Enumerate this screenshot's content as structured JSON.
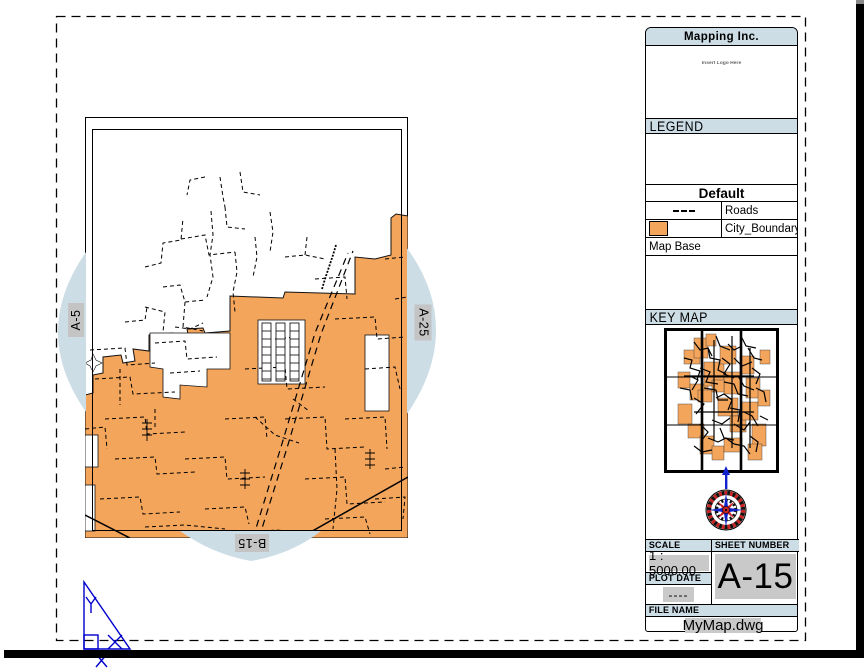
{
  "colors": {
    "band": "#ccdde6",
    "lens": "#ccdde6",
    "orange": "#f3a55c",
    "graybox": "#c4c4c4",
    "fieldgray": "#c9c9c9",
    "ucs_blue": "#0000cc",
    "compass_red": "#cc2222",
    "compass_blue": "#1122cc"
  },
  "sheet_labels": {
    "left": "A-5",
    "right": "A-25",
    "bottom": "B-15"
  },
  "title_block": {
    "company": "Mapping Inc.",
    "logo_placeholder": "Insert Logo Here",
    "legend": {
      "header": "LEGEND",
      "group": "Default",
      "items": [
        {
          "symbol": "dashed-line",
          "label": "Roads"
        },
        {
          "symbol": "orange-swatch",
          "label": "City_Boundary"
        }
      ],
      "footer": "Map Base"
    },
    "key_map_header": "KEY MAP",
    "scale": {
      "label": "SCALE",
      "value": "1 : 5000.00"
    },
    "sheet_number": {
      "label": "SHEET NUMBER",
      "value": "A-15"
    },
    "plot_date": {
      "label": "PLOT DATE",
      "value": "----"
    },
    "file_name": {
      "label": "FILE NAME",
      "value": "MyMap.dwg"
    }
  },
  "map_art": {
    "boundary": "0,421 0,278 8,276 8,258 18,256 18,240 36,238 38,246 50,244 48,232 64,234 64,218 88,216 90,224 104,222 102,212 118,211 120,216 145,214 145,179 198,181 200,175 270,177 270,140 290,142 306,138 306,101 311,97 323,99 323,421",
    "hole_step": "65,216 145,216 145,252 122,252 122,270 95,268 95,282 78,280 78,252 65,250",
    "hole_rects": [
      [
        173,
        203,
        47,
        64
      ],
      [
        280,
        218,
        24,
        76
      ],
      [
        0,
        318,
        13,
        32
      ],
      [
        0,
        368,
        10,
        46
      ]
    ],
    "star": "0,246 6,243 8,237 11,243 17,246 11,249 8,255 5,249",
    "ladders": [
      [
        177,
        206,
        9,
        58
      ],
      [
        191,
        206,
        9,
        58
      ],
      [
        205,
        206,
        9,
        58
      ]
    ],
    "diag": [
      "M168,421 L196,330 L230,216 L263,136",
      "M174,421 L202,331 L236,217 L268,134"
    ],
    "squiggle": "M237,172 l3,-10 l4,-12 l4,-12 l3,-10",
    "roads": [
      [
        "M60,150 l16,-4 l2,-20 l18,-3 l2,-22",
        "d"
      ],
      [
        "M96,122 l24,-4 l4,20 l26,-3",
        "d"
      ],
      [
        "M126,94 l2,24 l-3,20 l3,22 l-6,20",
        "d"
      ],
      [
        "M78,170 l17,-2 l5,17 l20,-2",
        "d"
      ],
      [
        "M60,190 l20,5 l-2,20",
        "d"
      ],
      [
        "M100,185 l-2,25 l20,4",
        "d"
      ],
      [
        "M140,90 l2,20 l18,2",
        "d"
      ],
      [
        "M150,135 l2,20 l-4,20 l2,20",
        "d"
      ],
      [
        "M170,120 l2,20 l-4,20",
        "d"
      ],
      [
        "M40,205 l20,-2 l2,-13",
        "d"
      ],
      [
        "M135,60 l3,20 l2,10",
        "d"
      ],
      [
        "M155,55 l3,20 l17,3",
        "d"
      ],
      [
        "M185,95 l3,20 l-3,20",
        "d"
      ],
      [
        "M200,140 l20,-2 l20,4",
        "d"
      ],
      [
        "M220,138 l2,-18",
        "d"
      ],
      [
        "M120,60 l-15,3 l-3,15",
        "d"
      ],
      [
        "M90,210 l15,2 l13,-6",
        "d"
      ],
      [
        "M5,233 l35,-2 l2,17 l28,-2",
        "d"
      ],
      [
        "M10,262 l35,-2 l3,17 l42,-2",
        "d"
      ],
      [
        "M20,302 l40,-2 l2,17 l38,-2",
        "d"
      ],
      [
        "M30,342 l40,-2 l2,17 l38,-2",
        "d"
      ],
      [
        "M15,382 l40,-2 l3,17 l37,-2",
        "d"
      ],
      [
        "M60,410 l40,-2 l40,4",
        "d"
      ],
      [
        "M120,392 l40,-2 l4,17",
        "d"
      ],
      [
        "M100,342 l40,-2 l2,22 l38,-2",
        "d"
      ],
      [
        "M140,302 l40,-2 l2,22",
        "d"
      ],
      [
        "M160,252 l40,-2 l2,22 l38,-2",
        "d"
      ],
      [
        "M200,302 l40,-2 l2,32 l38,-2",
        "d"
      ],
      [
        "M220,362 l40,-2 l2,27 l38,-2",
        "d"
      ],
      [
        "M240,402 l40,-2 l5,17",
        "d"
      ],
      [
        "M260,302 l40,-2 l2,32",
        "d"
      ],
      [
        "M280,252 l30,-2 l5,22",
        "d"
      ],
      [
        "M250,202 l40,-2 l2,22 l28,-2",
        "d"
      ],
      [
        "M190,222 l20,-2 l2,22",
        "d"
      ],
      [
        "M300,352 l20,-2",
        "d"
      ],
      [
        "M290,382 l30,-2 l-2,22",
        "d"
      ],
      [
        "M150,418 l40,-5 l40,3",
        "d"
      ],
      [
        "M0,312 l20,-2 l2,22",
        "d"
      ],
      [
        "M230,162 l30,-2 l2,22",
        "d"
      ],
      [
        "M300,142 l20,-2",
        "d"
      ],
      [
        "M310,182 l12,-2",
        "d"
      ],
      [
        "M250,332 l2,40 l-4,40",
        "d"
      ],
      [
        "M70,292 v20",
        "d"
      ],
      [
        "M35,252 v36",
        "d"
      ],
      [
        "M170,300 l20,18 l24,8",
        "d"
      ],
      [
        "M208,282 l16,12",
        "d"
      ],
      [
        "M70,226 l30,-2 l2,18 l30,-2",
        "d"
      ],
      [
        "M85,256 l30,-2",
        "d"
      ],
      [
        "M215,421 L323,360",
        "s"
      ],
      [
        "M0,398 L45,421",
        "s"
      ],
      [
        "M62,302 v22 M57,306 h10 M57,312 h10 M57,318 h10",
        "c"
      ],
      [
        "M160,352 v20 M155,356 h10 M155,362 h10 M155,368 h10",
        "c"
      ],
      [
        "M285,332 v20 M280,336 h10 M280,342 h10 M280,348 h10",
        "c"
      ]
    ],
    "keymap": {
      "vlines": [
        38,
        77
      ],
      "hlines": [
        49,
        97
      ],
      "patches": [
        [
          14,
          44,
          12,
          16
        ],
        [
          20,
          22,
          16,
          14
        ],
        [
          30,
          10,
          14,
          20
        ],
        [
          42,
          6,
          10,
          12
        ],
        [
          26,
          56,
          18,
          16
        ],
        [
          14,
          76,
          14,
          20
        ],
        [
          24,
          96,
          16,
          14
        ],
        [
          36,
          108,
          14,
          18
        ],
        [
          48,
          118,
          12,
          14
        ],
        [
          40,
          34,
          20,
          24
        ],
        [
          56,
          18,
          16,
          18
        ],
        [
          60,
          44,
          18,
          22
        ],
        [
          54,
          70,
          20,
          18
        ],
        [
          66,
          88,
          16,
          16
        ],
        [
          76,
          28,
          14,
          18
        ],
        [
          82,
          50,
          14,
          20
        ],
        [
          78,
          74,
          16,
          18
        ],
        [
          88,
          96,
          14,
          22
        ],
        [
          94,
          62,
          12,
          16
        ],
        [
          96,
          22,
          10,
          14
        ],
        [
          60,
          110,
          18,
          14
        ],
        [
          84,
          116,
          14,
          16
        ],
        [
          34,
          62,
          14,
          12
        ],
        [
          48,
          52,
          12,
          12
        ]
      ],
      "scribbles": [
        "M20,30 l8,2 l-2,8 l10,3 l-3,9",
        "M30,14 l6,8 l8,-2 l4,8",
        "M36,40 l10,4 l-4,10 l12,2",
        "M44,20 l2,10 l10,2 l-2,10 l8,4",
        "M52,8 l4,10 l10,4",
        "M58,30 l8,6 l-6,10 l10,4",
        "M40,60 l12,2 l2,10 l10,0",
        "M52,70 l8,-4 l8,6 l-4,10",
        "M30,70 l10,6 l-8,10",
        "M60,54 l10,2 l4,10 l10,2",
        "M70,30 l8,8 l10,-4",
        "M74,48 l6,10 l10,4",
        "M66,80 l10,2 l-2,12",
        "M48,92 l10,4 l8,-6",
        "M56,100 l4,10 l10,2",
        "M36,96 l8,8 l-6,8",
        "M70,96 l10,6 l6,-8",
        "M80,84 l8,4 l6,10",
        "M26,48 l8,4 l-6,10",
        "M16,60 l10,2 l2,10",
        "M84,20 l6,10 l8,2",
        "M88,40 l8,6 l-4,10",
        "M92,60 l8,4 l2,10",
        "M78,10 l4,8 l10,2",
        "M64,16 l6,6 l8,-4",
        "M44,110 l10,4 l8,-4 l8,6",
        "M70,116 l10,2 l6,8",
        "M30,118 l8,6 l10,-2",
        "M86,108 l8,6 l-2,10",
        "M96,88 l8,4",
        "M20,48 h70",
        "M30,84 h60",
        "M50,12 v100",
        "M68,8 v112",
        "M86,20 v100"
      ]
    }
  }
}
